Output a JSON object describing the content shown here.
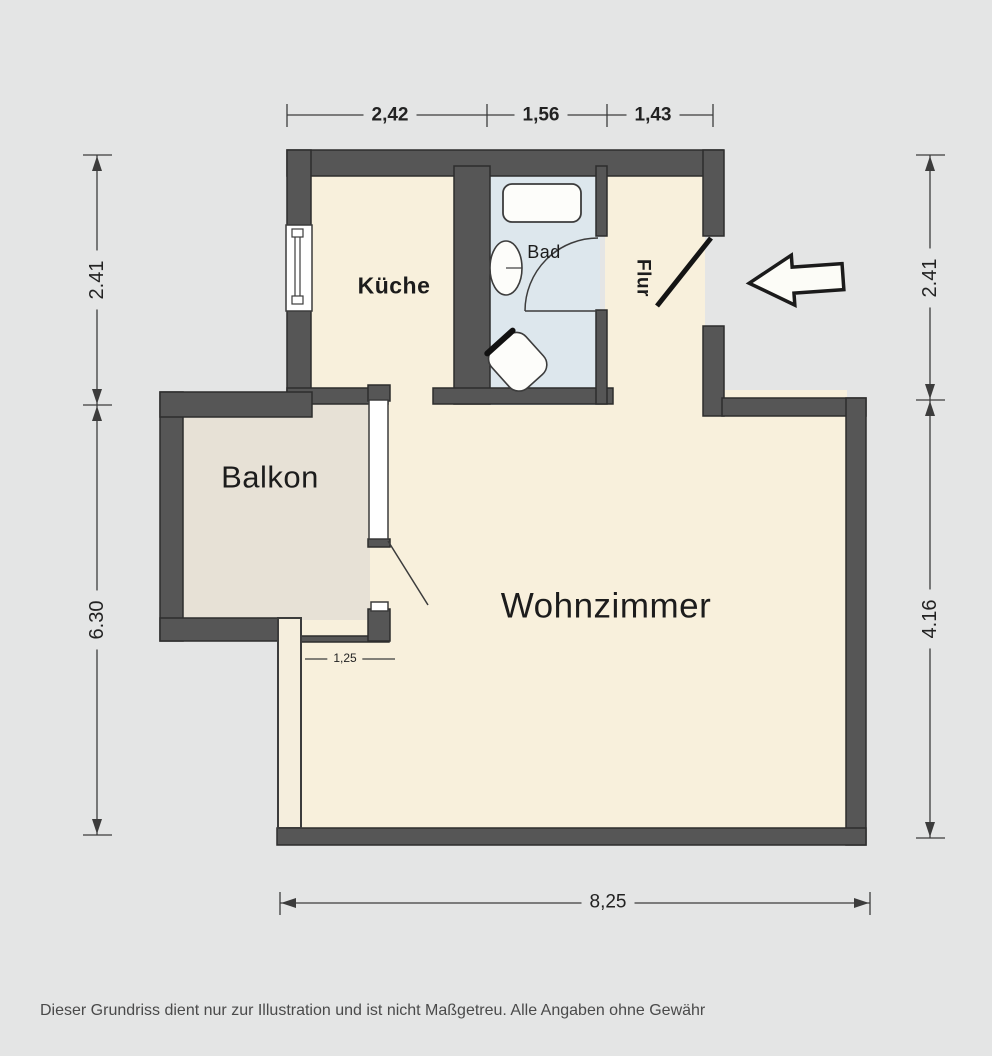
{
  "floorplan": {
    "rooms": {
      "kueche": "Küche",
      "bad": "Bad",
      "flur": "Flur",
      "balkon": "Balkon",
      "wohnzimmer": "Wohnzimmer"
    },
    "dimensions": {
      "top": [
        "2,42",
        "1,56",
        "1,43"
      ],
      "left": [
        "2.41",
        "6.30"
      ],
      "right": [
        "2.41",
        "4.16"
      ],
      "bottom": "8,25",
      "inner_width": "1,25"
    },
    "icons": {
      "entrance": "entrance-arrow-icon",
      "bathtub": "bathtub-icon",
      "sink": "sink-icon",
      "toilet": "toilet-icon",
      "window": "window-icon",
      "door_swing": "door-swing-icon"
    },
    "colors": {
      "wall": "#565656",
      "floor_main": "#f8f0dc",
      "floor_balcony": "#e7e1d6",
      "floor_bath": "#dde7ed",
      "background": "#e4e5e5",
      "fixture": "#fdfdfa"
    },
    "disclaimer": "Dieser Grundriss dient nur zur Illustration und ist nicht Maßgetreu. Alle Angaben ohne Gewähr"
  }
}
